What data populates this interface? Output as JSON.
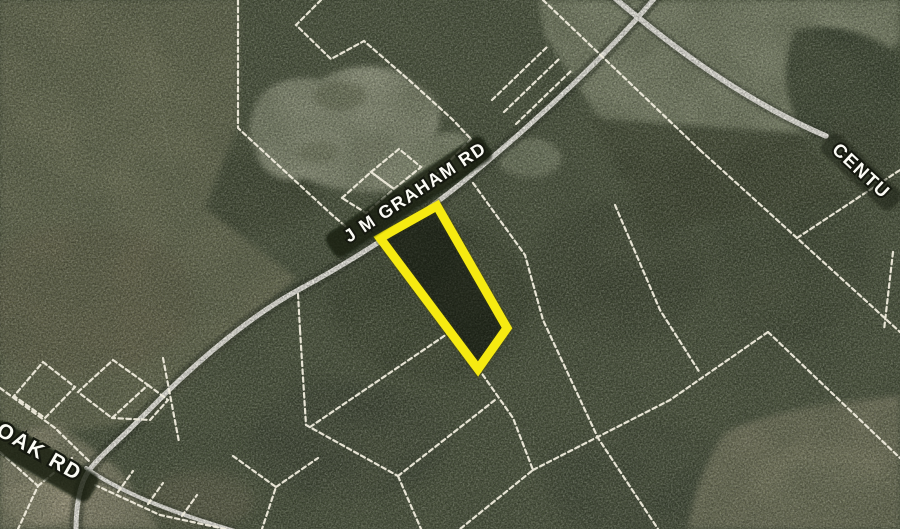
{
  "map": {
    "description": "Aerial satellite view with parcel boundary overlay and highlighted lot",
    "road_labels": [
      {
        "id": "jm-graham-rd",
        "text": "J M GRAHAM RD"
      },
      {
        "id": "oak-rd",
        "text": "OAK RD"
      },
      {
        "id": "century-rd",
        "text": "CENTU"
      }
    ],
    "highlighted_parcel": {
      "outline_color": "#f6ea11"
    },
    "colors": {
      "parcel_line": "#f0ecdd",
      "road": "#e9e8e0",
      "road_casing": "#2e3626",
      "forest": "#48513c",
      "field_olive": "#6e7156",
      "field_light": "#8d947a",
      "field_brown": "#7b7c63",
      "pond": "#9ca189",
      "label_text": "#fcfcf6",
      "label_halo": "#15180f"
    }
  }
}
